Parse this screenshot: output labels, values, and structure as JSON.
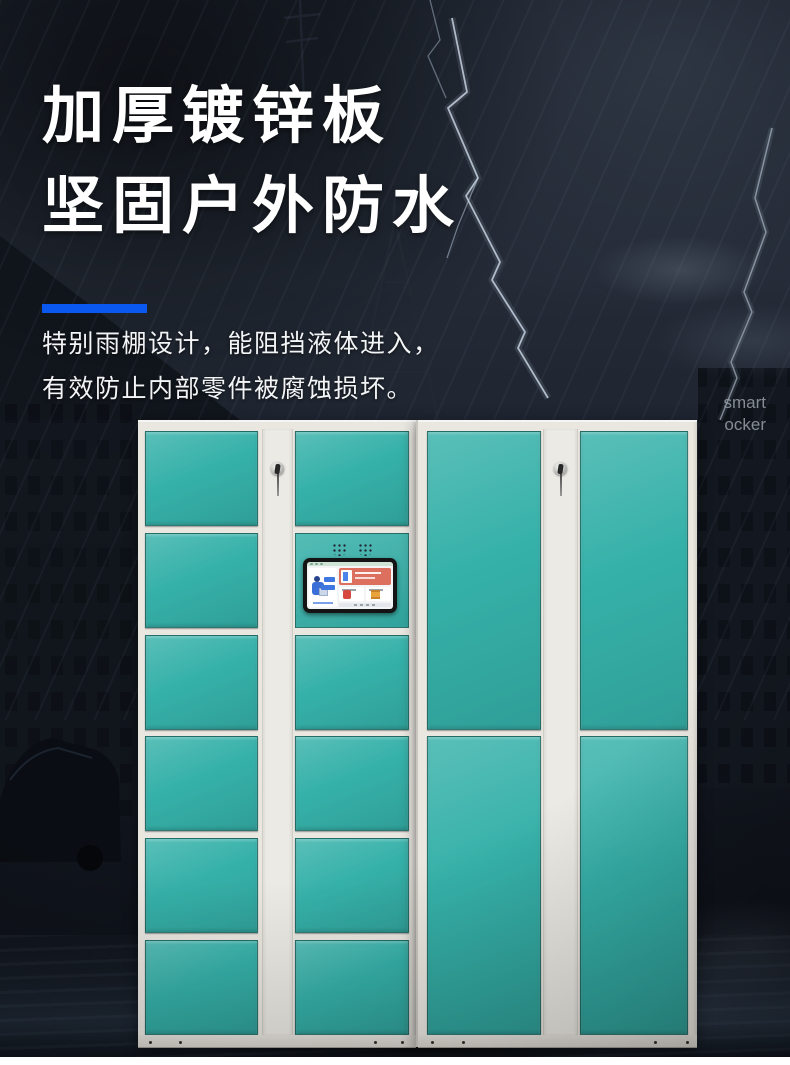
{
  "theme": {
    "page_bg": "#161b24",
    "accent_blue": "#0b58f0",
    "door_teal": "#35b1a9",
    "frame_white": "#eae7e1",
    "text_white": "#ffffff",
    "watermark_gray": "#9aa0a6",
    "screen_banner": "#dd6f5e",
    "screen_bg": "#f2f4f6",
    "bezel_black": "#141414"
  },
  "hero": {
    "title_line1": "加厚镀锌板",
    "title_line2": "坚固户外防水",
    "subtitle_line1": "特别雨棚设计，能阻挡液体进入，",
    "subtitle_line2": "有效防止内部零件被腐蚀损坏。"
  },
  "watermark": {
    "line1": "smart",
    "line2": "ocker"
  },
  "locker": {
    "description": "outdoor smart parcel locker, two joined units, teal doors on off-white frame",
    "left_unit": {
      "left_column_small_doors": 6,
      "right_column_small_doors": 5,
      "has_control_panel": true,
      "key_lock_on_strip": true
    },
    "right_unit": {
      "columns": 2,
      "tall_doors_per_column": 2,
      "key_lock_on_strip": true
    },
    "icons": {
      "key_lock": "key-lock-icon",
      "speaker": "speaker-grille-icon",
      "screen": "kiosk-touchscreen",
      "lightning": "lightning-bolt",
      "tower": "transmission-tower",
      "rain": "rain-streaks"
    }
  }
}
